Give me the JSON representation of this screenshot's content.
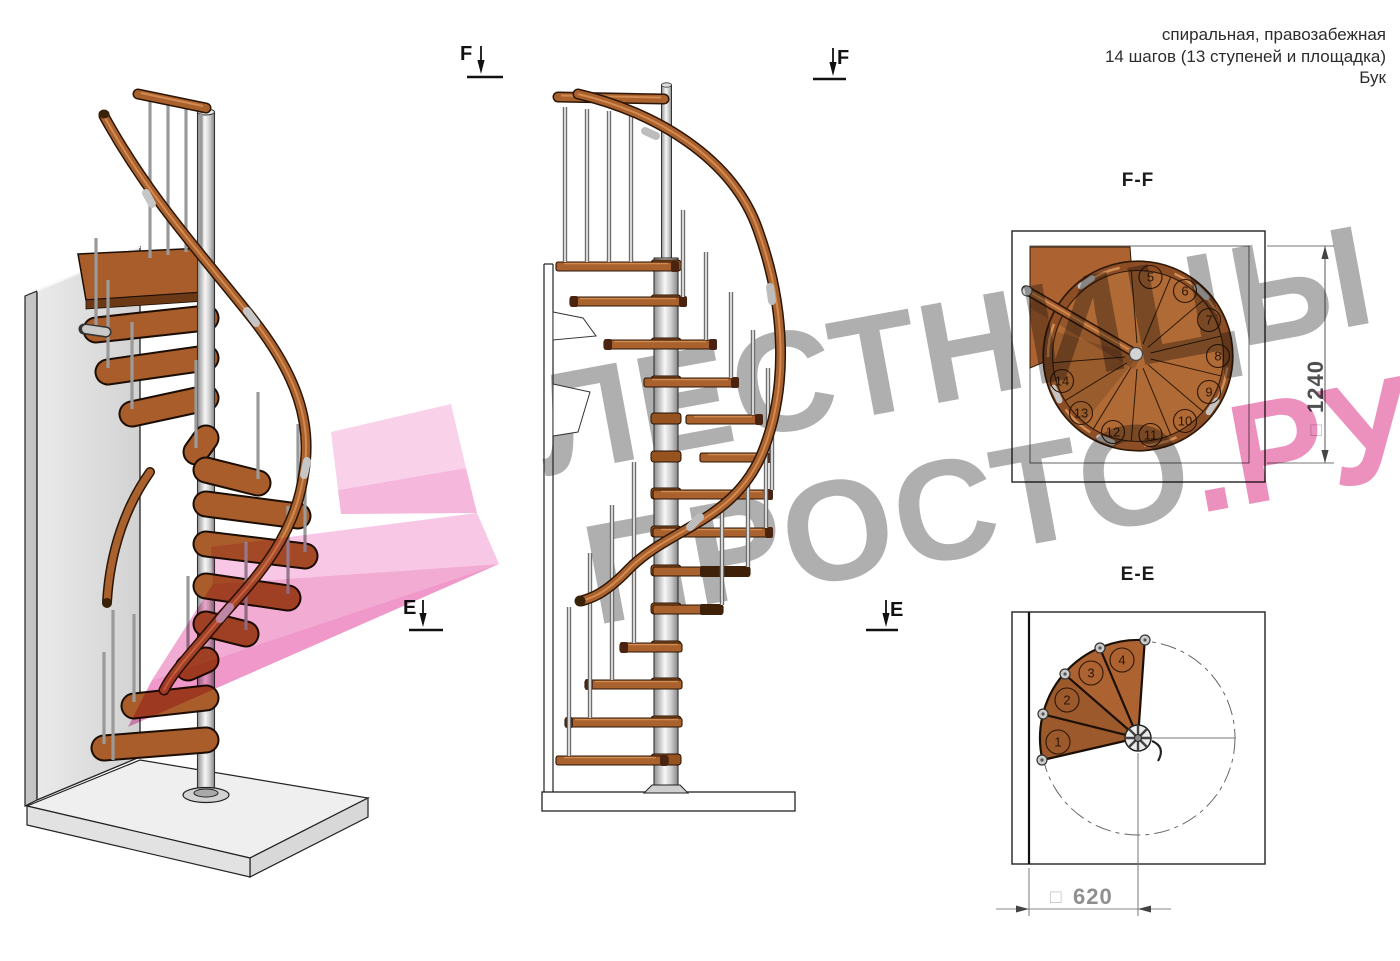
{
  "header": {
    "line1": "спиральная, правозабежная",
    "line2": "14 шагов (13 ступеней и площадка)",
    "line3": "Бук"
  },
  "watermark": {
    "line1": "ЛЕСТНИЦЫ",
    "line2_gray": "ПРОСТО",
    "line2_pink": ".РУ"
  },
  "markers": {
    "f": "F",
    "e": "E"
  },
  "ff": {
    "title": "F-F",
    "dim_box": "□",
    "dim_value": "1240",
    "steps": [
      "5",
      "6",
      "7",
      "8",
      "9",
      "10",
      "11",
      "12",
      "13",
      "14"
    ]
  },
  "ee": {
    "title": "E-E",
    "dim_box": "□",
    "dim_value": "620",
    "steps": [
      "1",
      "2",
      "3",
      "4"
    ]
  },
  "palette": {
    "wood": "#a9612e",
    "metal": "#d9d9d9",
    "watermark_gray": "#9e9e9e",
    "watermark_pink": "#e877ae",
    "arrow_pink": "#f3a7d2"
  }
}
